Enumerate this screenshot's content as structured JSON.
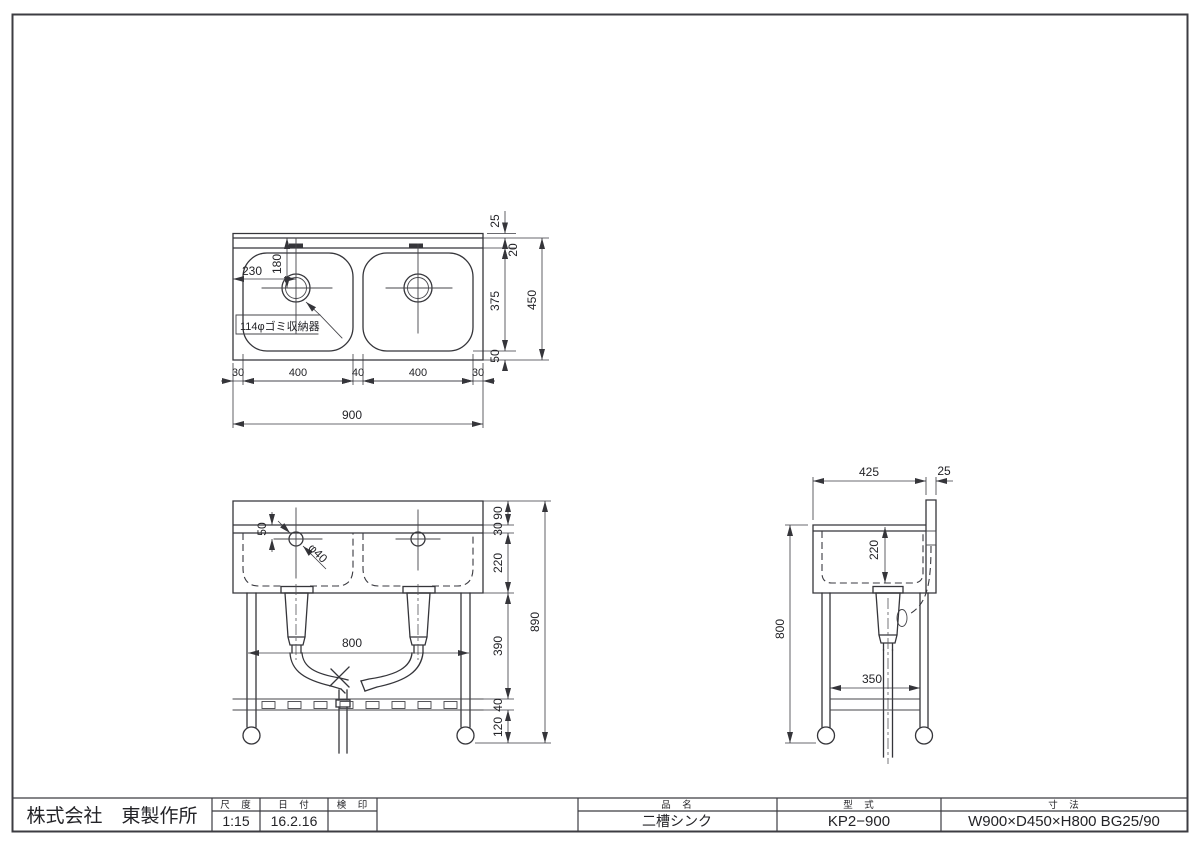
{
  "page": {
    "background": "#ffffff",
    "line_color": "#35353a"
  },
  "top_view": {
    "dim_230": "230",
    "dim_180": "180",
    "note_drain": "114φゴミ収納器",
    "dim_25": "25",
    "dim_20": "20",
    "dim_375": "375",
    "dim_50": "50",
    "dim_450": "450",
    "chain": [
      "30",
      "400",
      "40",
      "400",
      "30"
    ],
    "dim_900": "900"
  },
  "front_view": {
    "dim_50": "50",
    "dim_phi40": "φ40",
    "dim_800": "800",
    "chain": [
      "90",
      "30",
      "220",
      "390",
      "40",
      "120"
    ],
    "dim_890": "890"
  },
  "side_view": {
    "dim_425": "425",
    "dim_25": "25",
    "dim_220": "220",
    "dim_800": "800",
    "dim_350": "350"
  },
  "title_block": {
    "company": "株式会社　東製作所",
    "scale_label": "尺　度",
    "scale_value": "1:15",
    "date_label": "日　付",
    "date_value": "16.2.16",
    "stamp_label": "検　印",
    "item_label": "品　名",
    "item_value": "二槽シンク",
    "model_label": "型　式",
    "model_value": "KP2−900",
    "size_label": "寸　法",
    "size_value": "W900×D450×H800 BG25/90"
  }
}
